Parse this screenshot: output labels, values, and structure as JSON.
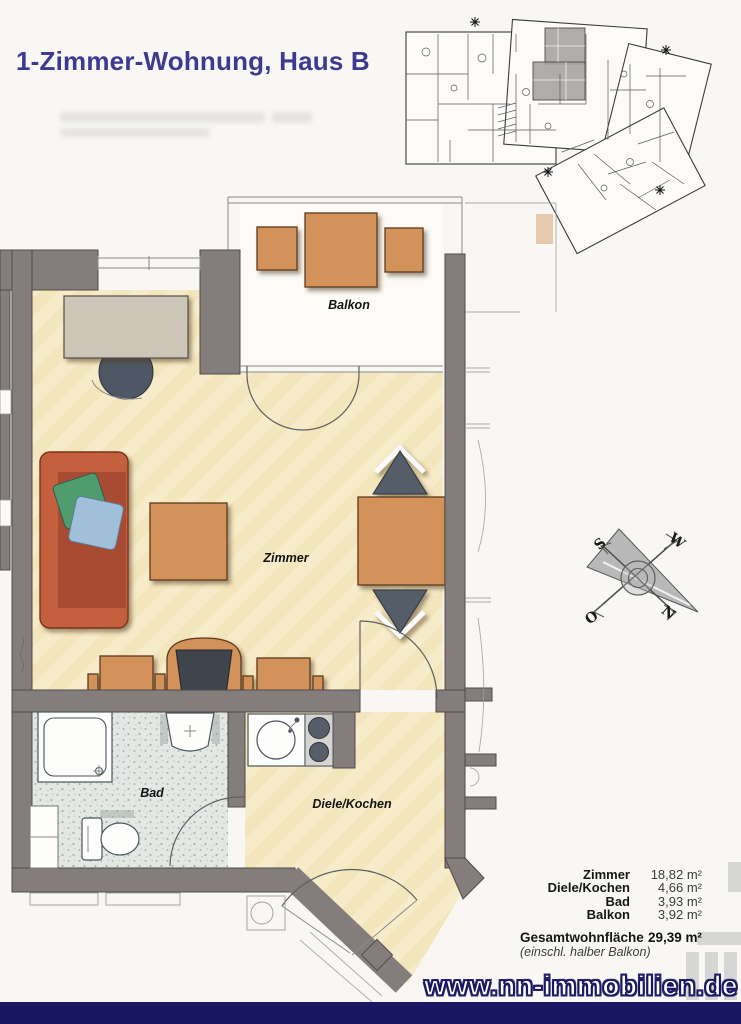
{
  "header": {
    "title": "1-Zimmer-Wohnung, Haus B"
  },
  "floor_plan": {
    "rooms": {
      "balkon": "Balkon",
      "zimmer": "Zimmer",
      "bad": "Bad",
      "diele_kochen": "Diele/Kochen"
    }
  },
  "compass": {
    "north": "N",
    "south": "S",
    "west": "W",
    "east": "O"
  },
  "area_table": {
    "rows": [
      {
        "label": "Zimmer",
        "value": "18,82 m²"
      },
      {
        "label": "Diele/Kochen",
        "value": "4,66 m²"
      },
      {
        "label": "Bad",
        "value": "3,93 m²"
      },
      {
        "label": "Balkon",
        "value": "3,92 m²"
      }
    ],
    "total_label": "Gesamtwohnfläche",
    "total_value": "29,39 m²",
    "note": "(einschl. halber Balkon)"
  },
  "footer": {
    "website": "www.nn-immobilien.de"
  },
  "colors": {
    "accent": "#3d3a90",
    "navy": "#191661",
    "wall": "#837e7b",
    "orange": "#d2925a",
    "sofa": "#c4613d",
    "dark": "#555d68",
    "floor": "#f7ecca"
  }
}
